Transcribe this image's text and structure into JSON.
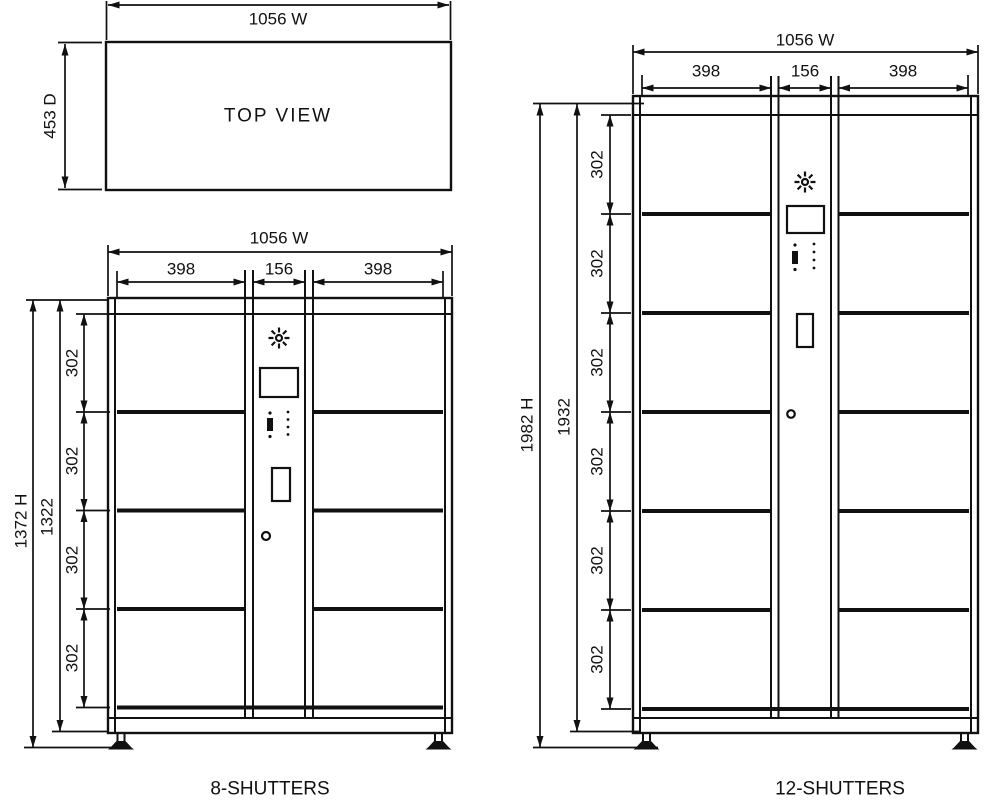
{
  "diagram": {
    "background": "#ffffff",
    "line_color": "#111111",
    "top_view": {
      "title": "TOP VIEW",
      "width_label": "1056 W",
      "depth_label": "453 D"
    },
    "cabinet_8": {
      "title": "8-SHUTTERS",
      "width_label": "1056 W",
      "col_labels": [
        "398",
        "156",
        "398"
      ],
      "height_label": "1372 H",
      "body_height_label": "1322",
      "row_labels": [
        "302",
        "302",
        "302",
        "302"
      ]
    },
    "cabinet_12": {
      "title": "12-SHUTTERS",
      "width_label": "1056 W",
      "col_labels": [
        "398",
        "156",
        "398"
      ],
      "height_label": "1982 H",
      "body_height_label": "1932",
      "row_labels": [
        "302",
        "302",
        "302",
        "302",
        "302",
        "302"
      ]
    }
  }
}
